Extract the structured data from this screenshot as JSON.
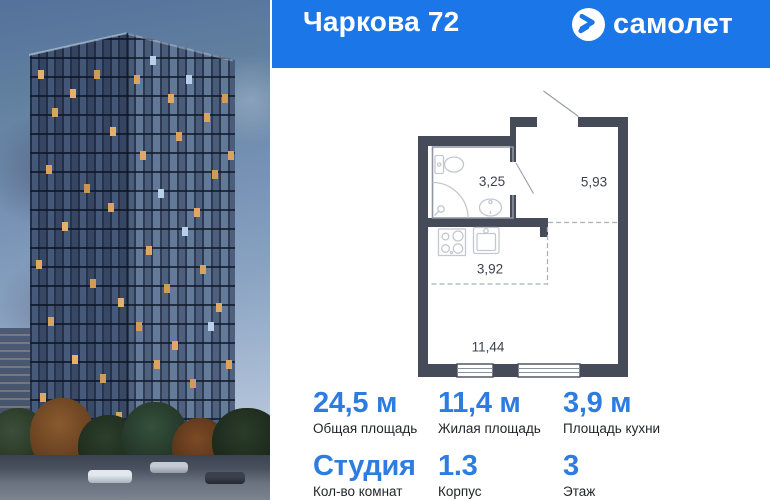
{
  "header": {
    "project_title": "Чаркова 72",
    "brand": "самолет",
    "bg_color": "#1B76E8"
  },
  "plan": {
    "wall_color": "#454B59",
    "rooms": [
      {
        "name": "bathroom",
        "area_label": "3,25"
      },
      {
        "name": "hallway",
        "area_label": "5,93"
      },
      {
        "name": "kitchen",
        "area_label": "3,92"
      },
      {
        "name": "living-room",
        "area_label": "11,44"
      }
    ]
  },
  "stats": {
    "accent_color": "#2E7CE0",
    "items": [
      {
        "value": "24,5 м",
        "label": "Общая площадь"
      },
      {
        "value": "11,4 м",
        "label": "Жилая площадь"
      },
      {
        "value": "3,9 м",
        "label": "Площадь кухни"
      },
      {
        "value": "Студия",
        "label": "Кол-во комнат"
      },
      {
        "value": "1.3",
        "label": "Корпус"
      },
      {
        "value": "3",
        "label": "Этаж"
      }
    ]
  }
}
